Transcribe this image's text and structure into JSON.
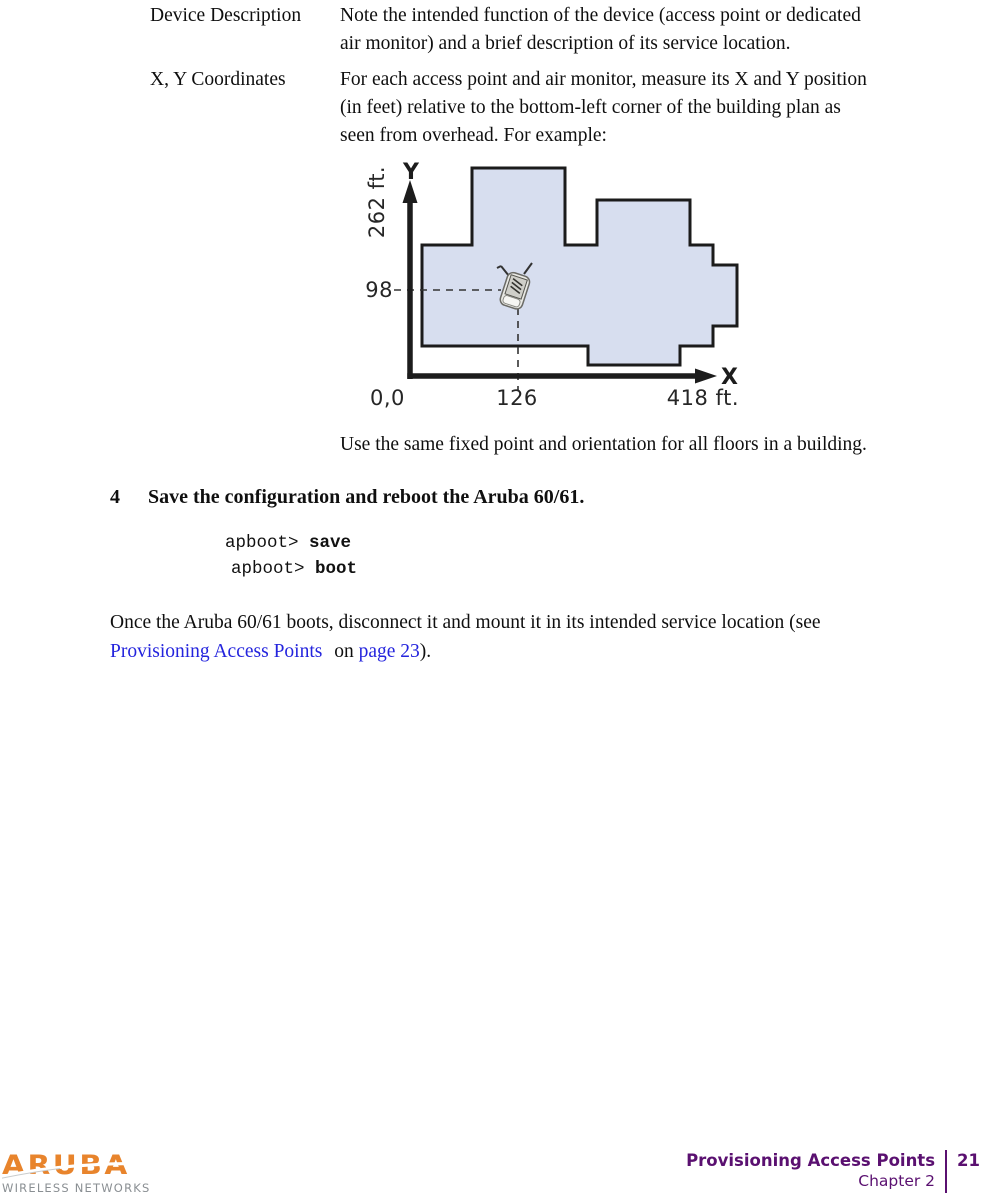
{
  "definitions": [
    {
      "term": "Device Description",
      "desc_lines": [
        "Note the intended function of the device (access point or dedicated",
        "air monitor) and a brief description of its service location."
      ]
    },
    {
      "term": "X, Y Coordinates",
      "desc_lines": [
        "For each access point and air monitor, measure its X and Y position",
        "(in feet) relative to the bottom-left corner of the building plan as",
        "seen from overhead. For example:"
      ]
    }
  ],
  "diagram": {
    "y_axis_letter": "Y",
    "x_axis_letter": "X",
    "y_max_label": "262 ft.",
    "y_point_label": "98",
    "origin_label": "0,0",
    "x_point_label": "126",
    "x_max_label": "418 ft.",
    "building_fill": "#d7deef",
    "outline_color": "#1b1b1b",
    "device_icon": "access-point-icon"
  },
  "note_after_diagram": "Use the same fixed point and orientation for all floors in a building.",
  "step": {
    "number": "4",
    "text": "Save the configuration and reboot the Aruba 60/61."
  },
  "code_block": {
    "lines": [
      {
        "prompt": "apboot> ",
        "command": "save"
      },
      {
        "prompt": "apboot> ",
        "command": "boot"
      }
    ]
  },
  "closing_paragraph": {
    "line1": "Once the Aruba 60/61 boots, disconnect it and mount it in its intended service location (see",
    "link1": "Provisioning Access Points",
    "between": " on ",
    "link2": "page 23",
    "after": ").",
    "link_color": "#2424dd"
  },
  "footer": {
    "logo": {
      "brand": "ARUBA",
      "tagline": "WIRELESS NETWORKS",
      "brand_color": "#e8842c",
      "tagline_color": "#8a8f93"
    },
    "doc_title": "Provisioning Access Points",
    "chapter": "Chapter 2",
    "page_number": "21",
    "accent_color": "#5a1070"
  }
}
